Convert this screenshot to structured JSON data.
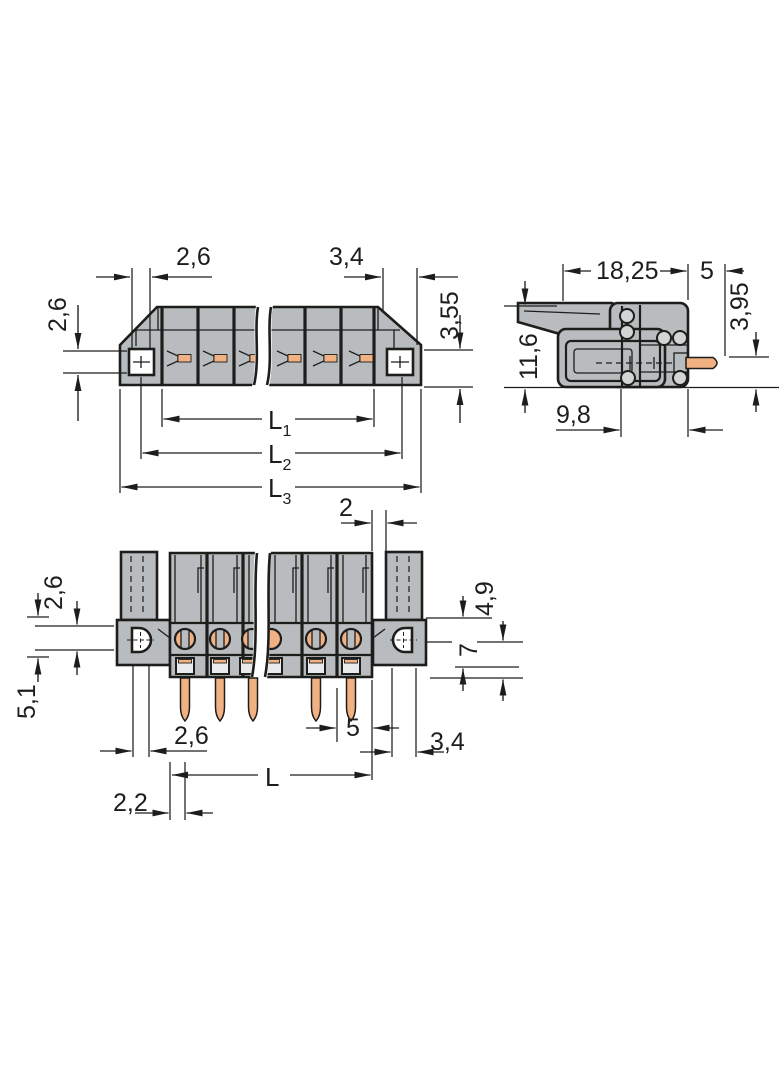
{
  "colors": {
    "background": "#ffffff",
    "body_gray": "#b8bcbe",
    "line": "#1d1d1b",
    "pin_copper": "#f2b183"
  },
  "views": {
    "front": {
      "dims": {
        "top_left": "2,6",
        "top_right": "3,4",
        "left": "2,6",
        "right": "3,55",
        "l1": "L",
        "l1_sub": "1",
        "l2": "L",
        "l2_sub": "2",
        "l3": "L",
        "l3_sub": "3"
      }
    },
    "side": {
      "dims": {
        "width": "18,25",
        "pin_len": "5",
        "height": "11,6",
        "pin_offset": "3,95",
        "depth": "9,8"
      }
    },
    "bottom": {
      "dims": {
        "slot": "2",
        "hole_h": "2,6",
        "flange_h": "5,1",
        "upper": "4,9",
        "mid": "7",
        "hole_w": "2,6",
        "pitch": "5",
        "flange_w": "3,4",
        "length": "L",
        "edge": "2,2"
      }
    }
  }
}
